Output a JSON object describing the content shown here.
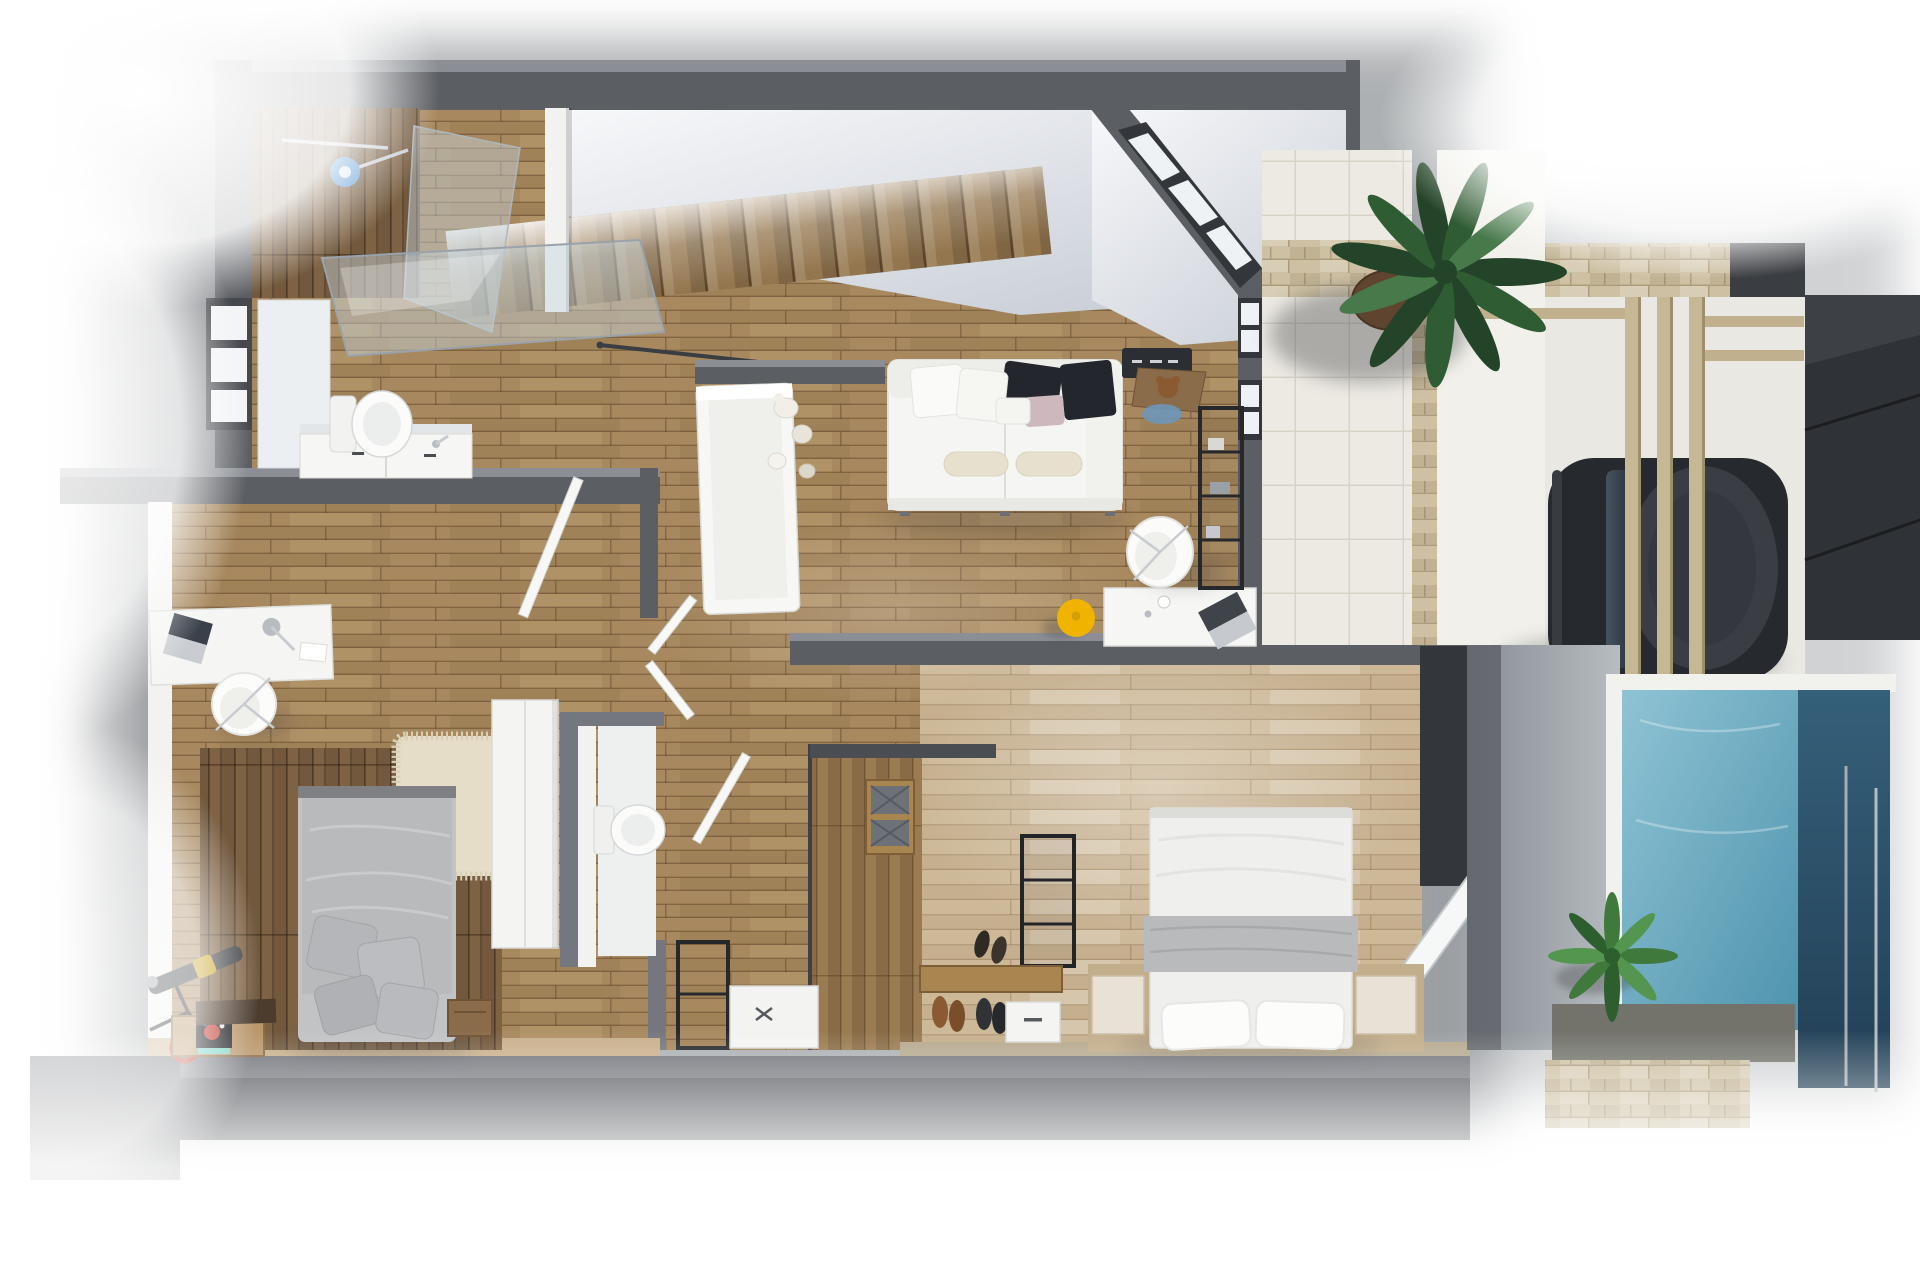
{
  "scene": {
    "description": "Photorealistic top-down 3D rendering of a single-storey modern apartment floor plan with bathroom, two bedrooms, living room, walk-in closet, entry porch with large plant, pergola carport with parked car, shaded deck and swimming pool",
    "view": "top-down axonometric",
    "visible_text": ""
  },
  "palette": {
    "bg": "#ffffff",
    "wall": "#5b5e63",
    "wall_top": "#8b8f95",
    "wall_light": "#74777d",
    "white_wall": "#f2f2f0",
    "frame_dark": "#33363b",
    "wood1": "#a8895f",
    "wood2": "#94764e",
    "wood3": "#bb9d72",
    "woodwall1": "#7d6244",
    "woodwall2": "#6a5138",
    "woodlight1": "#cdb998",
    "woodlight2": "#bda684",
    "closet1": "#9a7b52",
    "tile": "#edeae3",
    "tile_line": "#d7d2c6",
    "stone": "#cec1a3",
    "stone_line": "#ab9c7c",
    "pool1": "#8fc3d4",
    "pool2": "#4e93ad",
    "pool_dark1": "#35607a",
    "pool_dark2": "#223f55",
    "deck1": "#878d93",
    "deck2": "#b7bcc1",
    "ceil1": "#c9ced7",
    "ceil2": "#f7f8fa",
    "glass": "rgba(198,212,222,0.45)",
    "sofa": "#f5f5f3",
    "pillow_dark": "#23262c",
    "pillow_blush": "#cdb8bd",
    "bolster": "#e7e0cf",
    "bed_gray": "#b9babc",
    "duvet": "#efefed",
    "rug": "#e6ddc8",
    "yellow": "#f0b400",
    "red": "#c23b2e",
    "blue_cloth": "#6d97b8",
    "shower_blue": "#5b9bd5",
    "plant_dark": "#234428",
    "plant_mid": "#2f5c33",
    "plant_light": "#47794a",
    "car_body": "#26292d",
    "car_glass1": "#46525f",
    "car_glass2": "#2b333c",
    "dark_panel": "#2f3237",
    "chrome": "#c8ccd1",
    "mat": "#2b2e33",
    "teddy": "#8a5a33",
    "wood_item": "#8a6b4a"
  },
  "rooms": [
    {
      "name": "bathroom",
      "items": [
        "wood-accent-wall",
        "towel-bar",
        "shower-head",
        "shower-glass-screen",
        "leaning-mirror-pane",
        "vanity-counter",
        "vanity-cabinet-doors",
        "twin-faucets",
        "toilet",
        "window-louvers"
      ]
    },
    {
      "name": "staircase",
      "items": [
        "wood-treads",
        "handrail",
        "upper-floor-void"
      ]
    },
    {
      "name": "living-room",
      "items": [
        "white-sofa",
        "dark-cushions",
        "white-cushions",
        "blush-cushion",
        "bolster-pillows",
        "plush-toys",
        "white-cabinet",
        "wall-stub",
        "desk",
        "laptop",
        "coffee-cup",
        "shell-chair",
        "yellow-pouf",
        "doormat",
        "wooden-stool",
        "teddy-bear",
        "blue-cloth",
        "black-shelf-unit",
        "interior-windows"
      ]
    },
    {
      "name": "hallway",
      "items": [
        "double-doors",
        "door-leaf",
        "white-cube-table",
        "black-rack"
      ]
    },
    {
      "name": "wc",
      "items": [
        "toilet",
        "white-partition-walls"
      ]
    },
    {
      "name": "left-bedroom",
      "items": [
        "desk",
        "laptop",
        "desk-lamp",
        "paper-sheet",
        "swivel-chair",
        "shag-rug",
        "double-bed",
        "gray-pillows",
        "wood-accent-niche",
        "telescope",
        "red-toy-wheel",
        "picture-crate",
        "dark-crate",
        "side-crate",
        "tall-white-wardrobe"
      ]
    },
    {
      "name": "walk-in-closet",
      "items": [
        "plank-divider-floor",
        "basket-shelf",
        "rattan-baskets",
        "black-clothes-rack",
        "sandals",
        "shoe-bench",
        "shoes",
        "white-drawer-box"
      ]
    },
    {
      "name": "master-bedroom",
      "items": [
        "double-bed",
        "gray-blanket",
        "white-pillows",
        "wood-platform",
        "nightstands",
        "dark-wardrobe",
        "glass-door-leaf"
      ]
    },
    {
      "name": "entry-porch",
      "items": [
        "ceiling-void",
        "diagonal-corner-windows",
        "large-tropical-plant",
        "plant-pot"
      ]
    },
    {
      "name": "terrace",
      "items": [
        "tile-floor",
        "stone-planter-band",
        "stone-pillar-band"
      ]
    },
    {
      "name": "carport",
      "items": [
        "pergola-beams",
        "parked-car",
        "stone-back-wall",
        "dark-boundary-panels"
      ]
    },
    {
      "name": "pool-area",
      "items": [
        "pool-water",
        "pool-dark-lane",
        "white-coping",
        "shaded-deck",
        "small-plant",
        "stone-path",
        "stone-front-wall",
        "glass-fence"
      ]
    },
    {
      "name": "left-terrace",
      "items": [
        "overexposed-white-floor",
        "floor-slab-edge",
        "perimeter-wall"
      ]
    }
  ]
}
